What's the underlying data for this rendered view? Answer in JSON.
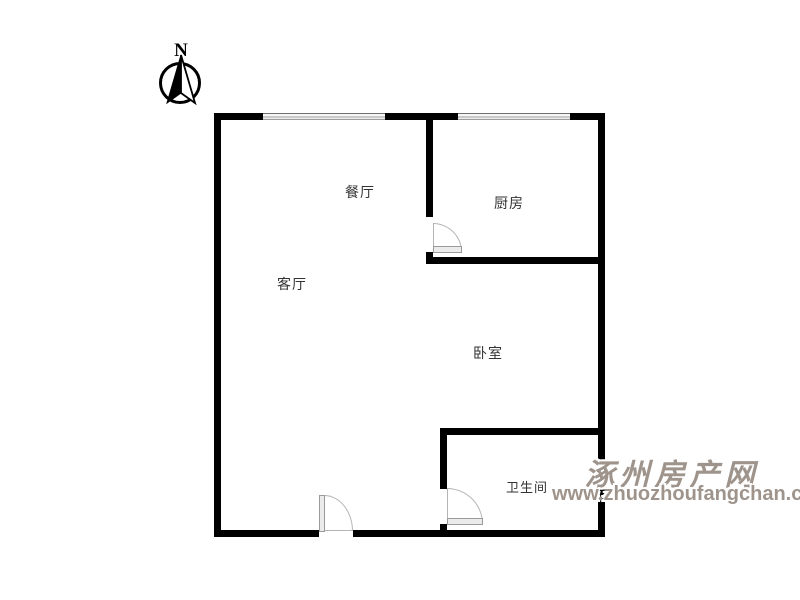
{
  "compass": {
    "north_label": "N"
  },
  "rooms": [
    {
      "id": "dining",
      "label": "餐厅"
    },
    {
      "id": "kitchen",
      "label": "厨房"
    },
    {
      "id": "living",
      "label": "客厅"
    },
    {
      "id": "bedroom",
      "label": "卧室"
    },
    {
      "id": "bathroom",
      "label": "卫生间"
    }
  ],
  "watermark": {
    "site_name": "涿州房产网",
    "site_url": "www.zhuozhoufangchan.com"
  },
  "colors": {
    "wall": "#000000",
    "room_label": "#333333",
    "watermark": "#9e948c",
    "background": "#ffffff"
  }
}
